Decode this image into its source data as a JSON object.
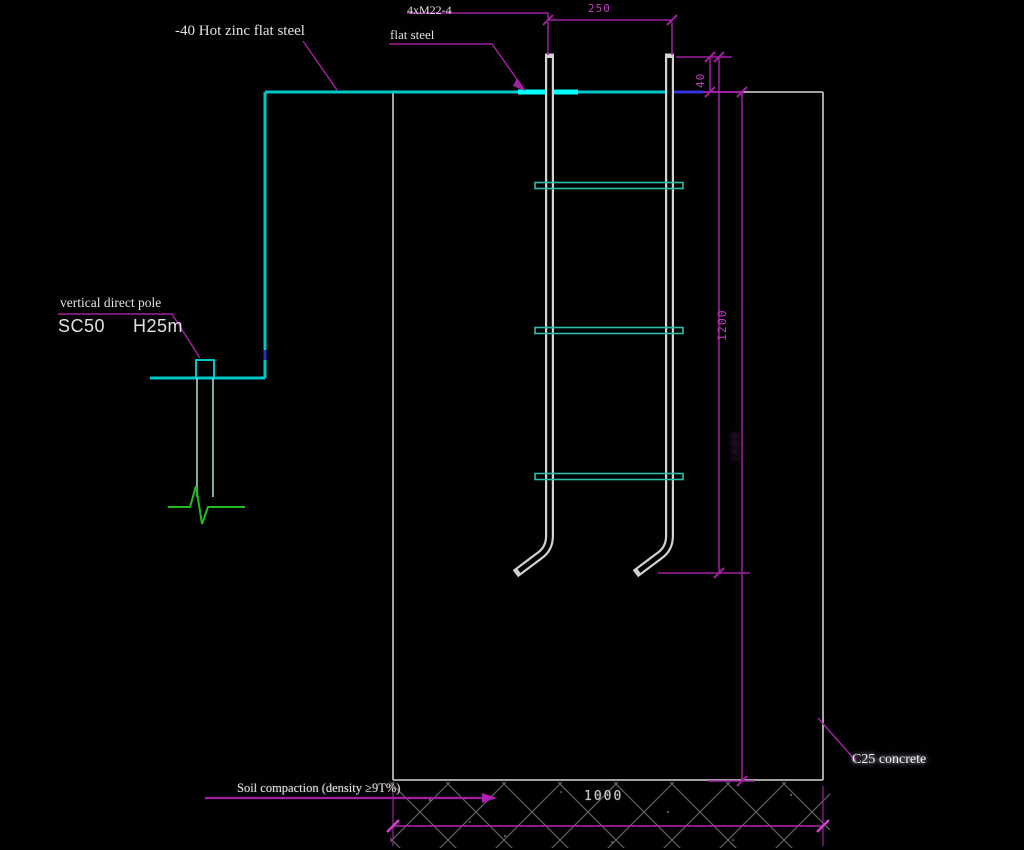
{
  "drawing": {
    "labels": {
      "hot_zinc": "-40 Hot zinc flat steel",
      "bolt_spec": "4xM22-4",
      "flat_steel": "flat steel",
      "pole_leader": "vertical direct pole",
      "pole_spec_left": "SC50",
      "pole_spec_right": "H25m",
      "soil": "Soil compaction (density ≥9T%)",
      "concrete": "C25 concrete"
    },
    "dimensions": {
      "anchor_spacing": "250",
      "bolt_projection": "40",
      "bolt_length": "1200",
      "embed_depth_faint": "1600",
      "foundation_width": "1000"
    },
    "colors": {
      "background": "#010101",
      "flat_steel_cyan": "#00c8c8",
      "flat_steel_bright": "#00ffff",
      "blue_segment": "#3333dd",
      "dimension_magenta": "#a020a0",
      "structure_gray": "#b8b8b8",
      "bolt_white": "#d2d2d2",
      "crossbar_teal": "#2fbcaa",
      "break_green": "#22bb22",
      "text_white": "#e2e2e2"
    }
  }
}
